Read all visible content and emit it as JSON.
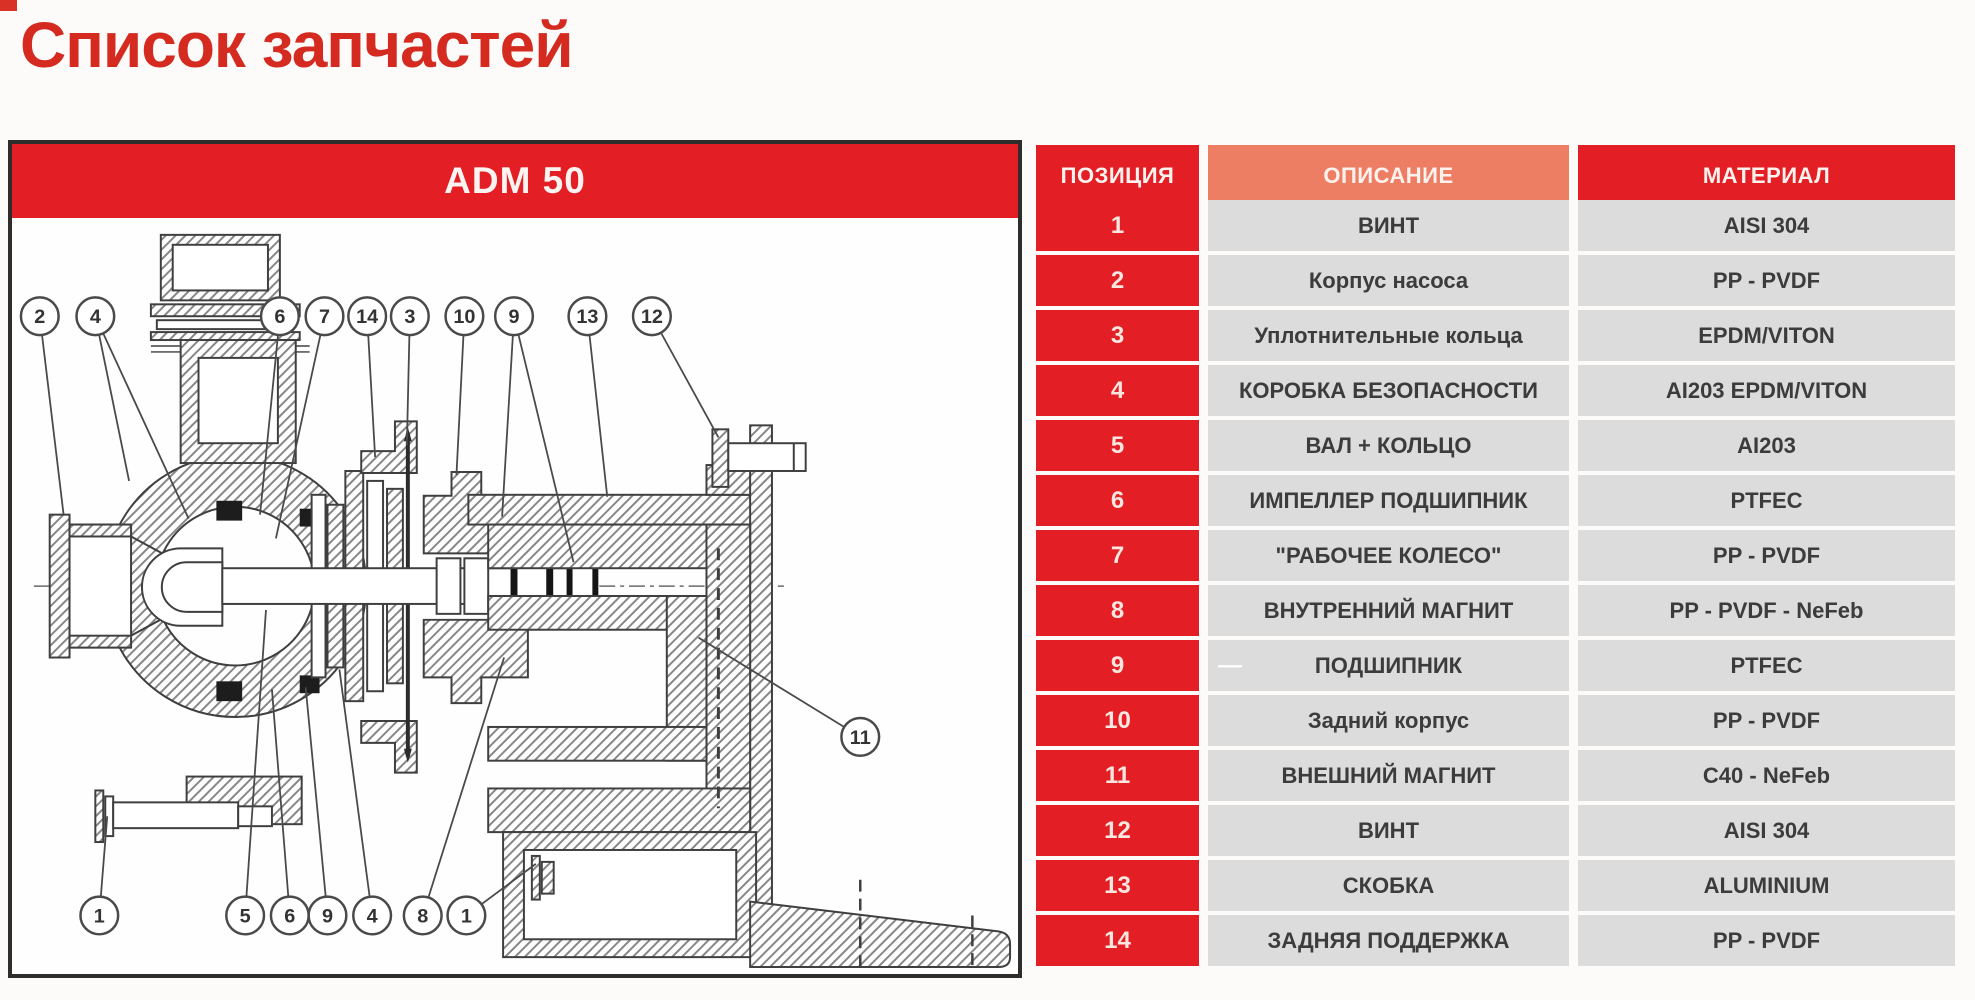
{
  "page": {
    "title": "Список запчастей"
  },
  "panel": {
    "header": "ADM 50"
  },
  "table": {
    "headers": {
      "position": "ПОЗИЦИЯ",
      "description": "ОПИСАНИЕ",
      "material": "МАТЕРИАЛ"
    },
    "rows": [
      {
        "pos": "1",
        "desc": "ВИНТ",
        "mat": "AISI 304"
      },
      {
        "pos": "2",
        "desc": "Корпус насоса",
        "mat": "PP - PVDF"
      },
      {
        "pos": "3",
        "desc": "Уплотнительные кольца",
        "mat": "EPDM/VITON"
      },
      {
        "pos": "4",
        "desc": "КОРОБКА БЕЗОПАСНОСТИ",
        "mat": "AI203 EPDM/VITON"
      },
      {
        "pos": "5",
        "desc": "ВАЛ + КОЛЬЦО",
        "mat": "AI203"
      },
      {
        "pos": "6",
        "desc": "ИМПЕЛЛЕР ПОДШИПНИК",
        "mat": "PTFEC"
      },
      {
        "pos": "7",
        "desc": "\"РАБОЧЕЕ КОЛЕСО\"",
        "mat": "PP - PVDF"
      },
      {
        "pos": "8",
        "desc": "ВНУТРЕННИЙ МАГНИТ",
        "mat": "PP - PVDF - NeFeb"
      },
      {
        "pos": "9",
        "desc": "ПОДШИПНИК",
        "mat": "PTFEC",
        "marker": "—"
      },
      {
        "pos": "10",
        "desc": "Задний корпус",
        "mat": "PP - PVDF"
      },
      {
        "pos": "11",
        "desc": "ВНЕШНИЙ МАГНИТ",
        "mat": "C40 - NeFeb"
      },
      {
        "pos": "12",
        "desc": "ВИНТ",
        "mat": "AISI 304"
      },
      {
        "pos": "13",
        "desc": "СКОБКА",
        "mat": "ALUMINIUM"
      },
      {
        "pos": "14",
        "desc": "ЗАДНЯЯ ПОДДЕРЖКА",
        "mat": "PP - PVDF"
      }
    ]
  },
  "diagram": {
    "callouts": [
      {
        "label": "2",
        "x": 28,
        "y": 96,
        "targets": [
          [
            52,
            296
          ]
        ]
      },
      {
        "label": "4",
        "x": 84,
        "y": 96,
        "targets": [
          [
            118,
            262
          ],
          [
            178,
            300
          ]
        ]
      },
      {
        "label": "6",
        "x": 270,
        "y": 96,
        "targets": [
          [
            250,
            296
          ]
        ]
      },
      {
        "label": "7",
        "x": 315,
        "y": 96,
        "targets": [
          [
            266,
            320
          ]
        ]
      },
      {
        "label": "14",
        "x": 358,
        "y": 96,
        "targets": [
          [
            366,
            238
          ]
        ]
      },
      {
        "label": "3",
        "x": 401,
        "y": 96,
        "targets": [
          [
            398,
            226
          ]
        ]
      },
      {
        "label": "10",
        "x": 456,
        "y": 96,
        "targets": [
          [
            448,
            256
          ]
        ]
      },
      {
        "label": "9",
        "x": 506,
        "y": 96,
        "targets": [
          [
            494,
            298
          ],
          [
            566,
            344
          ]
        ]
      },
      {
        "label": "13",
        "x": 580,
        "y": 96,
        "targets": [
          [
            600,
            278
          ]
        ]
      },
      {
        "label": "12",
        "x": 645,
        "y": 96,
        "targets": [
          [
            712,
            218
          ]
        ]
      },
      {
        "label": "11",
        "x": 855,
        "y": 520,
        "targets": [
          [
            692,
            420
          ]
        ]
      },
      {
        "label": "1",
        "x": 88,
        "y": 700,
        "targets": [
          [
            96,
            600
          ]
        ]
      },
      {
        "label": "5",
        "x": 235,
        "y": 700,
        "targets": [
          [
            256,
            392
          ]
        ]
      },
      {
        "label": "6",
        "x": 280,
        "y": 700,
        "targets": [
          [
            262,
            472
          ]
        ]
      },
      {
        "label": "9",
        "x": 318,
        "y": 700,
        "targets": [
          [
            296,
            470
          ]
        ]
      },
      {
        "label": "4",
        "x": 363,
        "y": 700,
        "targets": [
          [
            330,
            452
          ]
        ]
      },
      {
        "label": "8",
        "x": 414,
        "y": 700,
        "targets": [
          [
            496,
            440
          ]
        ]
      },
      {
        "label": "1",
        "x": 458,
        "y": 700,
        "targets": [
          [
            528,
            648
          ]
        ]
      }
    ]
  },
  "colors": {
    "accent_red": "#e31e25",
    "salmon_header": "#ee7e63",
    "title_red": "#d42a20",
    "row_gray": "#d3d2d2",
    "row_gray_alt": "#dddcdc"
  }
}
